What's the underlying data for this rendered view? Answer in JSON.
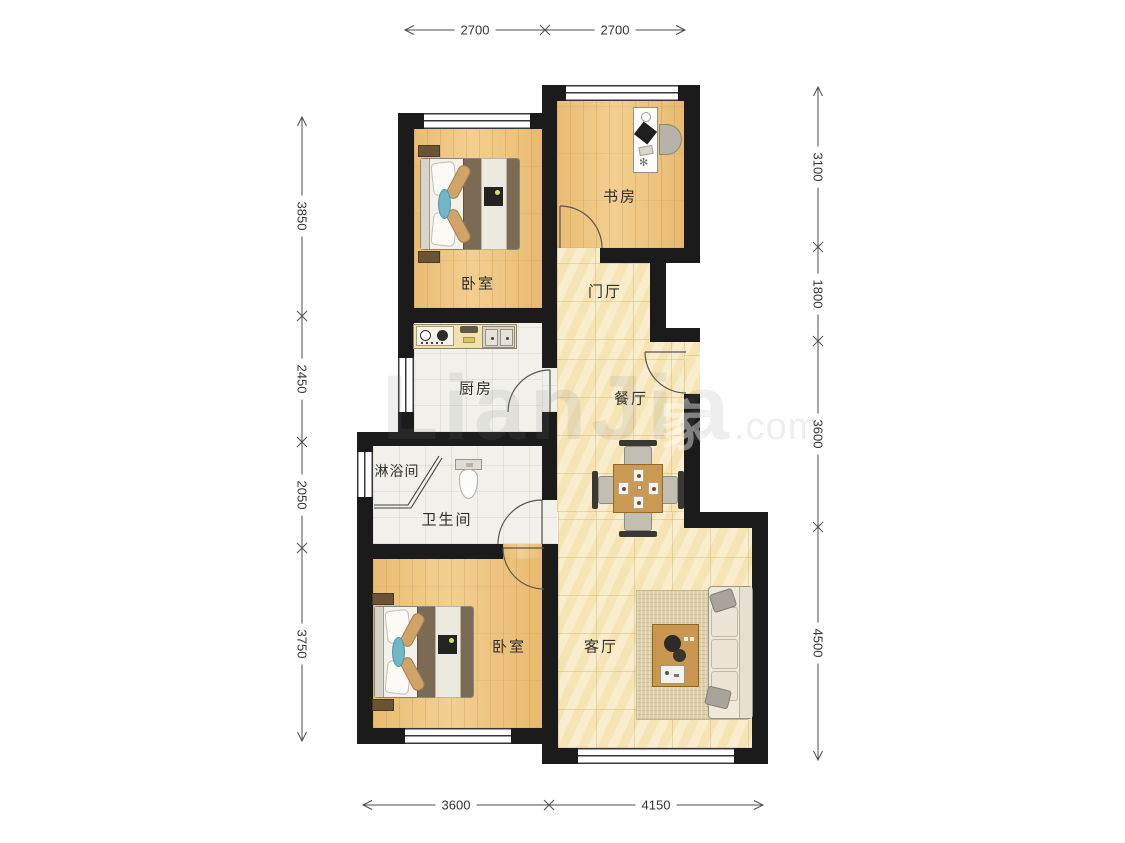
{
  "plan": {
    "title": "apartment-floor-plan",
    "watermark": {
      "brand": "LianJia",
      "suffix": ".com",
      "logo": "家"
    },
    "rooms": [
      {
        "id": "bedroom-top",
        "label": "卧室"
      },
      {
        "id": "study",
        "label": "书房"
      },
      {
        "id": "entry-hall",
        "label": "门厅"
      },
      {
        "id": "kitchen",
        "label": "厨房"
      },
      {
        "id": "dining-room",
        "label": "餐厅"
      },
      {
        "id": "shower-room",
        "label": "淋浴间"
      },
      {
        "id": "bathroom",
        "label": "卫生间"
      },
      {
        "id": "bedroom-bottom",
        "label": "卧室"
      },
      {
        "id": "living-room",
        "label": "客厅"
      }
    ],
    "dimensions_mm": {
      "top": [
        "2700",
        "2700"
      ],
      "bottom": [
        "3600",
        "4150"
      ],
      "left": [
        "3850",
        "2450",
        "2050",
        "3750"
      ],
      "right": [
        "3100",
        "1800",
        "3600",
        "4500"
      ]
    },
    "furniture": [
      "double-bed",
      "nightstand",
      "desk",
      "office-chair",
      "dining-table",
      "dining-chair",
      "sofa",
      "coffee-table",
      "rug",
      "toilet",
      "shower-screen",
      "stove",
      "sink"
    ],
    "colors": {
      "wall": "#1b1b1b",
      "wood_floor": "#ecc27d",
      "tile_floor": "#f7e9c0",
      "wet_floor": "#f1f0ea",
      "accent_teal": "#6fb7c9",
      "dimension_text": "#333333"
    }
  }
}
